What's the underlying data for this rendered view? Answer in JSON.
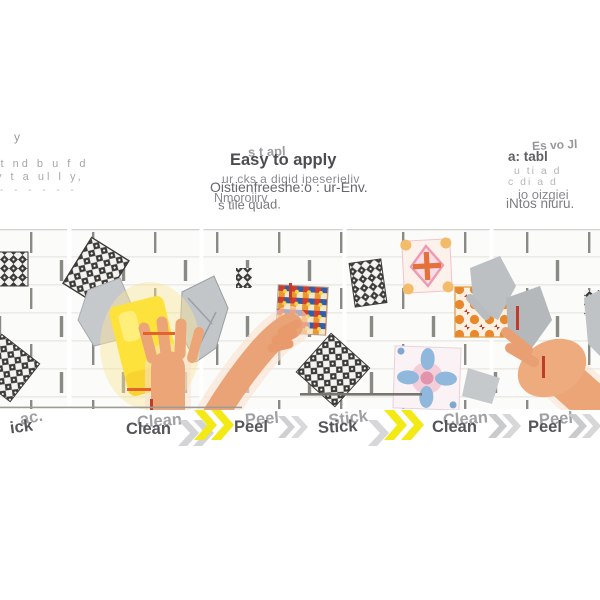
{
  "header": {
    "left": {
      "mark": "y",
      "line1": "st nd b u f d",
      "line2": "y t a ul l y,",
      "line3": "- -  - -  - -"
    },
    "center": {
      "heading": "Easy to apply",
      "heading_ghost": "s t apl",
      "line1": "Oistienfreeshe:o : ur-Env.",
      "line1_ghost": "ur cks a digid ipeserieliv",
      "line2": "s tile quad.",
      "line2_ghost": "Nmoroiirv"
    },
    "right": {
      "heading": "a: tabl",
      "heading_ghost": "Es vo Jl",
      "faint1": "u ti a d",
      "faint2": "c di  a d",
      "line3": "io oizgiei",
      "line4": "iNtos niuru."
    }
  },
  "steps": {
    "partial": {
      "text": "ick",
      "ghost": "ac."
    },
    "labels": [
      "Clean",
      "Peel",
      "Stick",
      "Clean",
      "Peel"
    ]
  },
  "icons": {
    "chevron": "double-chevron-right",
    "sponge": "yellow-cleaning-sponge",
    "hand": "hand-applying-tile-sticker"
  },
  "colors": {
    "chevron_yellow": "#f3e915",
    "chevron_grey": "#c5c6c8",
    "sponge_yellow": "#ffe23c",
    "skin": "#eaa377",
    "grey_hand": "#bcc0c3",
    "label_grey": "#55565a",
    "accent_red": "#c23b2a",
    "accent_orange": "#e2632e"
  }
}
